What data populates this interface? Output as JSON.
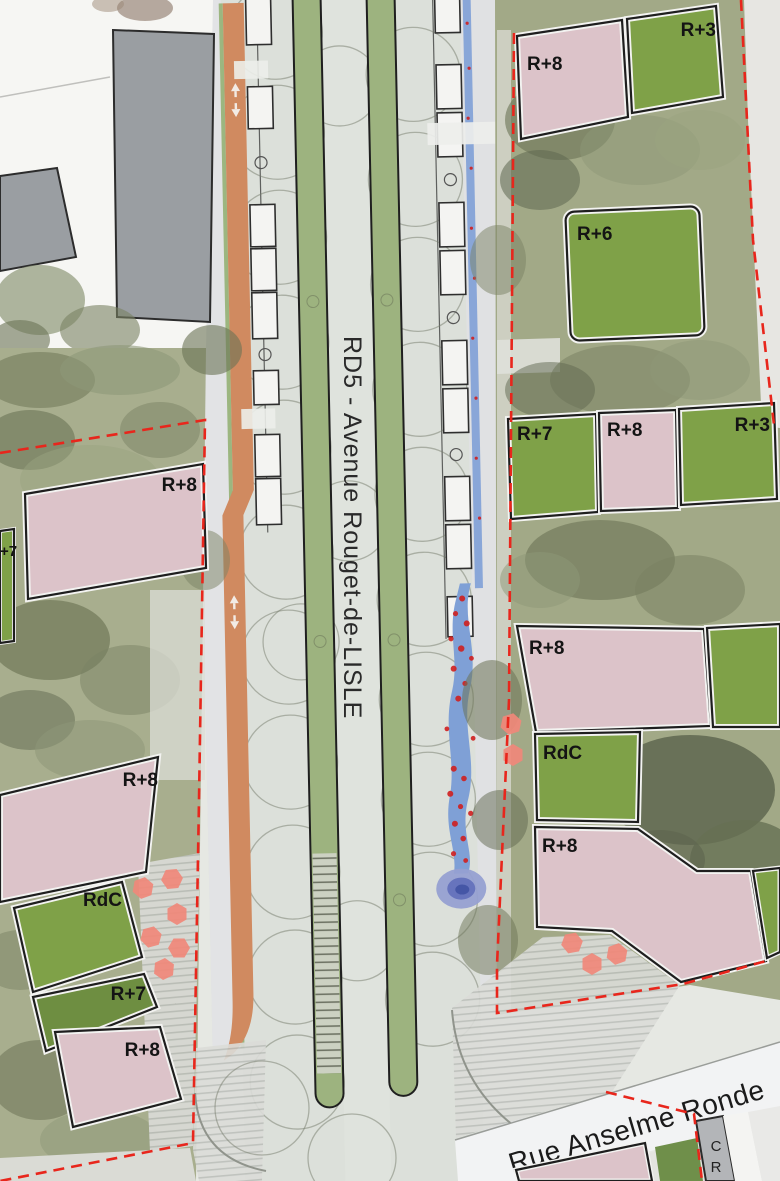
{
  "map": {
    "title": "urban landscape plan",
    "streets": {
      "avenue": "RD5 - Avenue Rouget-de-LISLE",
      "rue": "Rue Anselme Ronde",
      "corner_building": "CR"
    },
    "blocks": {
      "north_east": [
        {
          "label": "R+8"
        },
        {
          "label": "R+3"
        },
        {
          "label": "R+6"
        }
      ],
      "east_row": [
        {
          "label": "R+7"
        },
        {
          "label": "R+8"
        },
        {
          "label": "R+3"
        }
      ],
      "south_east": [
        {
          "label": "R+8"
        },
        {
          "label": "RdC"
        },
        {
          "label": "R+8"
        }
      ],
      "west": [
        {
          "label": "R+8"
        },
        {
          "label": "+7"
        }
      ],
      "south_west": [
        {
          "label": "R+8"
        },
        {
          "label": "RdC"
        },
        {
          "label": "R+7"
        },
        {
          "label": "R+8"
        }
      ]
    },
    "colors": {
      "building_pink": "#dcc3c9",
      "roof_green": "#7fa148",
      "existing_gray": "#9a9ea2",
      "bike_path_orange": "#d08a60",
      "tram_green": "#9db37f",
      "water_blue": "#7fa0d6",
      "flower_red": "#cf1f1f",
      "boundary_red": "#e8261c",
      "parasol_salmon": "#f0887a"
    }
  }
}
